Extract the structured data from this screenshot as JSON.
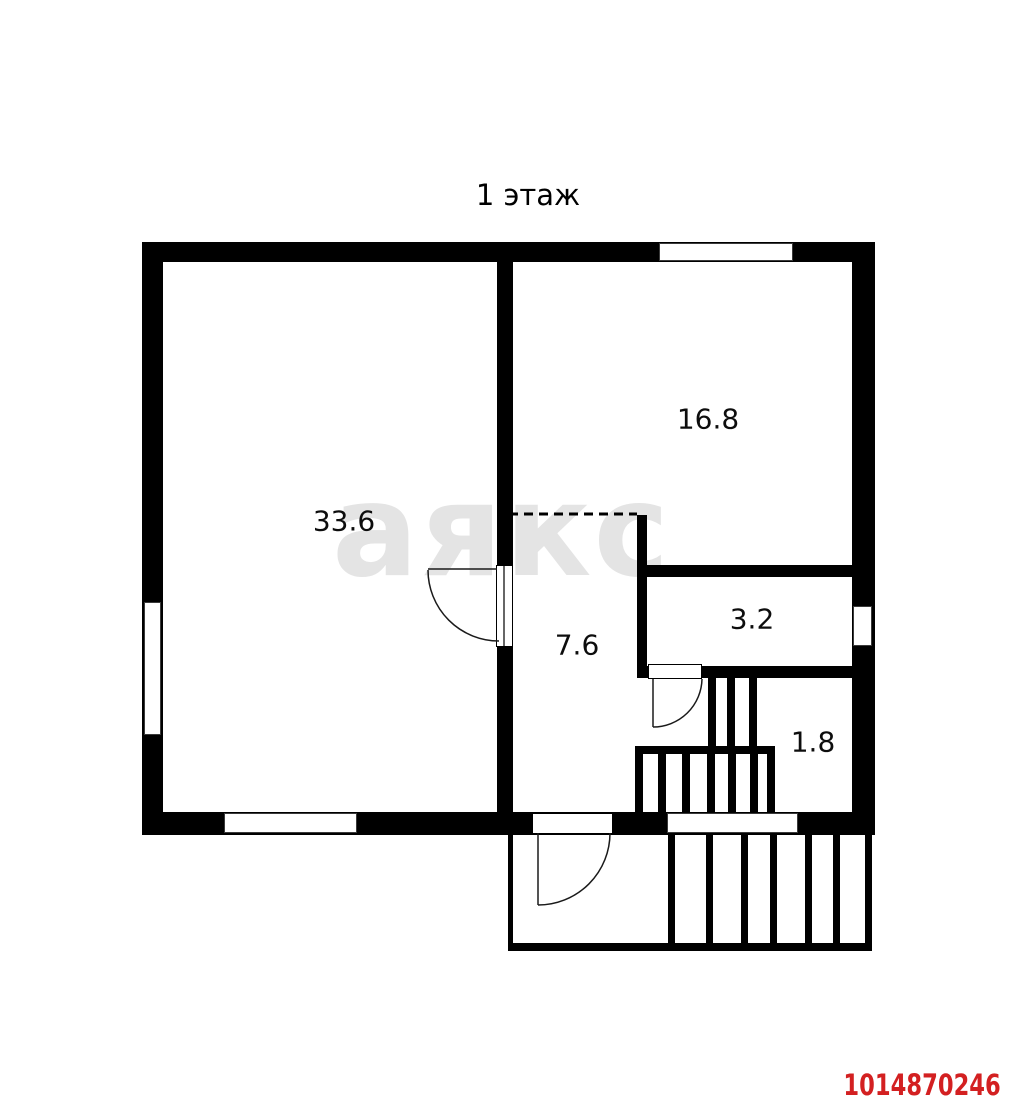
{
  "title": "1 этаж",
  "watermark": "аякс",
  "listing_id": "1014870246",
  "rooms": [
    {
      "area": "33.6"
    },
    {
      "area": "16.8"
    },
    {
      "area": "3.2"
    },
    {
      "area": "7.6"
    },
    {
      "area": "1.8"
    }
  ],
  "colors": {
    "background": "#ffffff",
    "wall": "#000000",
    "watermark": "#e4e4e4",
    "listing_id": "#d32021"
  }
}
